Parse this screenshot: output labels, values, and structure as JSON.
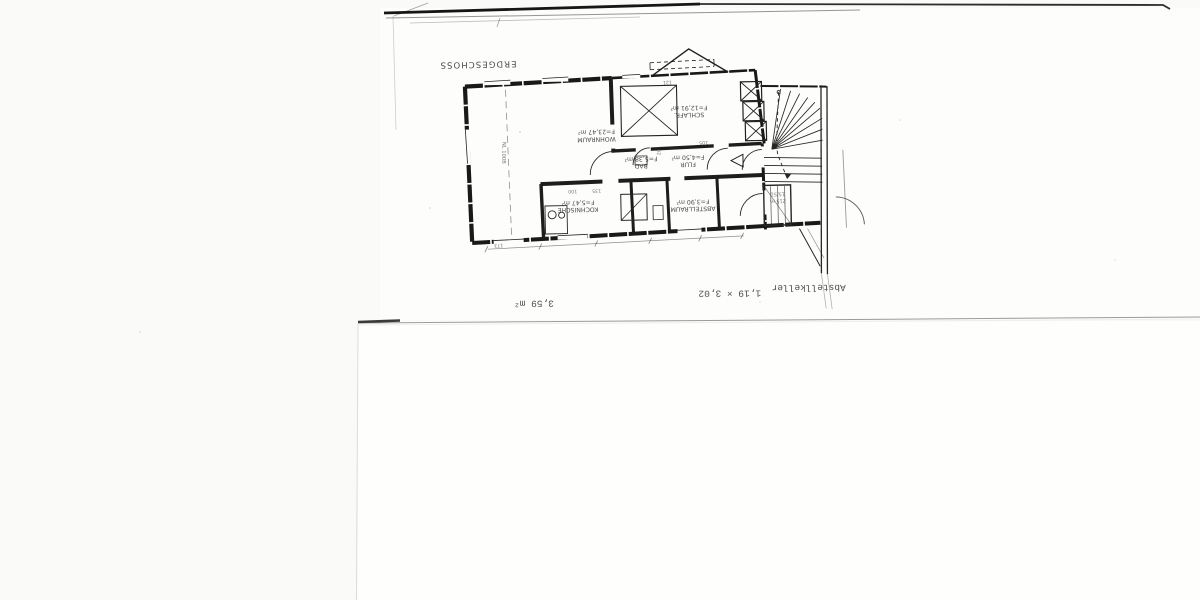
{
  "scan": {
    "background": "#fafaf8",
    "sheet_color": "#fdfdfb",
    "ink": "#1b1b1b"
  },
  "plan": {
    "title": "ERDGESCHOSS",
    "rooms": [
      {
        "name": "WOHNRAUM",
        "area": "F=23,47 m²"
      },
      {
        "name": "SCHLAFR.",
        "area": "F=12,91 m²"
      },
      {
        "name": "BAD",
        "area": "F=5,38 m²"
      },
      {
        "name": "FLUR",
        "area": "F=4,50 m²"
      },
      {
        "name": "ABSTELLRAUM",
        "area": "F=3,90 m²"
      },
      {
        "name": "KOCHNISCHE",
        "area": "F=5,47 m²"
      }
    ],
    "stair": {
      "line1": "15/51",
      "line2": "215 m"
    },
    "duct_label": "NL 100B",
    "dims": [
      "135",
      "100",
      "201",
      "105",
      "173",
      "121"
    ]
  },
  "annotations": {
    "cellar_label": "Abstellkeller",
    "cellar_dims": "1,19 × 3,02",
    "cellar_area": "3,59 m²"
  }
}
